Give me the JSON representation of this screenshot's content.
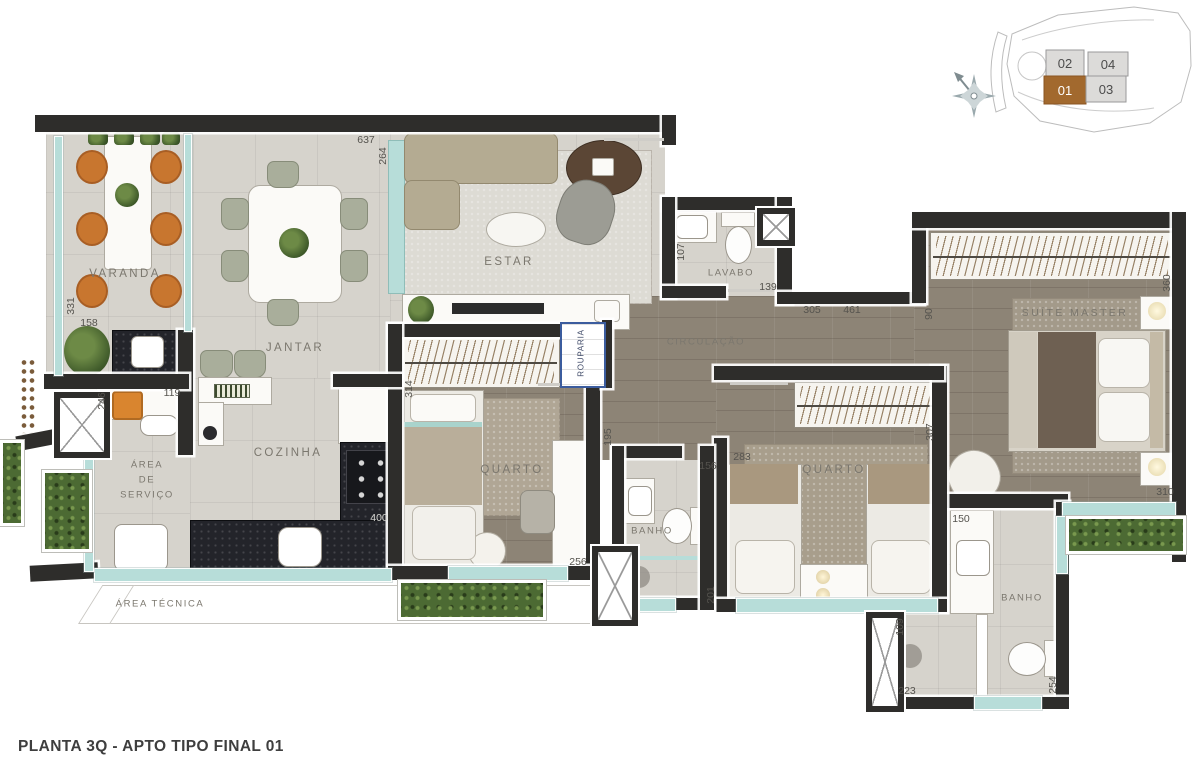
{
  "title": "PLANTA 3Q - APTO TIPO FINAL 01",
  "key_plan": {
    "units": [
      {
        "label": "02",
        "highlighted": false
      },
      {
        "label": "04",
        "highlighted": false
      },
      {
        "label": "01",
        "highlighted": true
      },
      {
        "label": "03",
        "highlighted": false
      }
    ],
    "highlight_color": "#a2692e"
  },
  "compass": {
    "icon": "north-arrow"
  },
  "rooms": {
    "varanda": "VARANDA",
    "jantar": "JANTAR",
    "estar": "ESTAR",
    "lavabo": "LAVABO",
    "circulacao": "CIRCULAÇÃO",
    "rouparia": "ROUPARIA",
    "cozinha": "COZINHA",
    "area_servico_lines": [
      "ÁREA",
      "DE",
      "SERVIÇO"
    ],
    "area_tecnica": "ÁREA TÉCNICA",
    "quarto_1": "QUARTO",
    "banho_1": "BANHO",
    "quarto_2": "QUARTO",
    "banho_2": "BANHO",
    "suite_master": "SUÍTE MASTER"
  },
  "dimensions": {
    "estar_top": "637",
    "estar_side": "264",
    "varanda_side": "331",
    "bancada_varanda": "158",
    "servico_side": "246",
    "servico_top": "119",
    "lavabo_side": "107",
    "lavabo_width": "139",
    "circ_a": "305",
    "circ_b": "461",
    "suite_entry": "90",
    "suite_side": "360",
    "quarto1_side": "314",
    "circ_side": "195",
    "banho1_top": "156",
    "quarto2_top": "283",
    "quarto2_side": "307",
    "cozinha_bancada": "400",
    "quarto1_width": "256",
    "banho1_side": "201",
    "banho2_top": "150",
    "suite_window": "310",
    "shower_side": "109",
    "shower_width": "223",
    "banho2_side": "254"
  },
  "colors": {
    "wall": "#2e2d2b",
    "glass": "#b7ddd9",
    "garden": "#4c6a33",
    "accent_unit": "#a2692e"
  }
}
